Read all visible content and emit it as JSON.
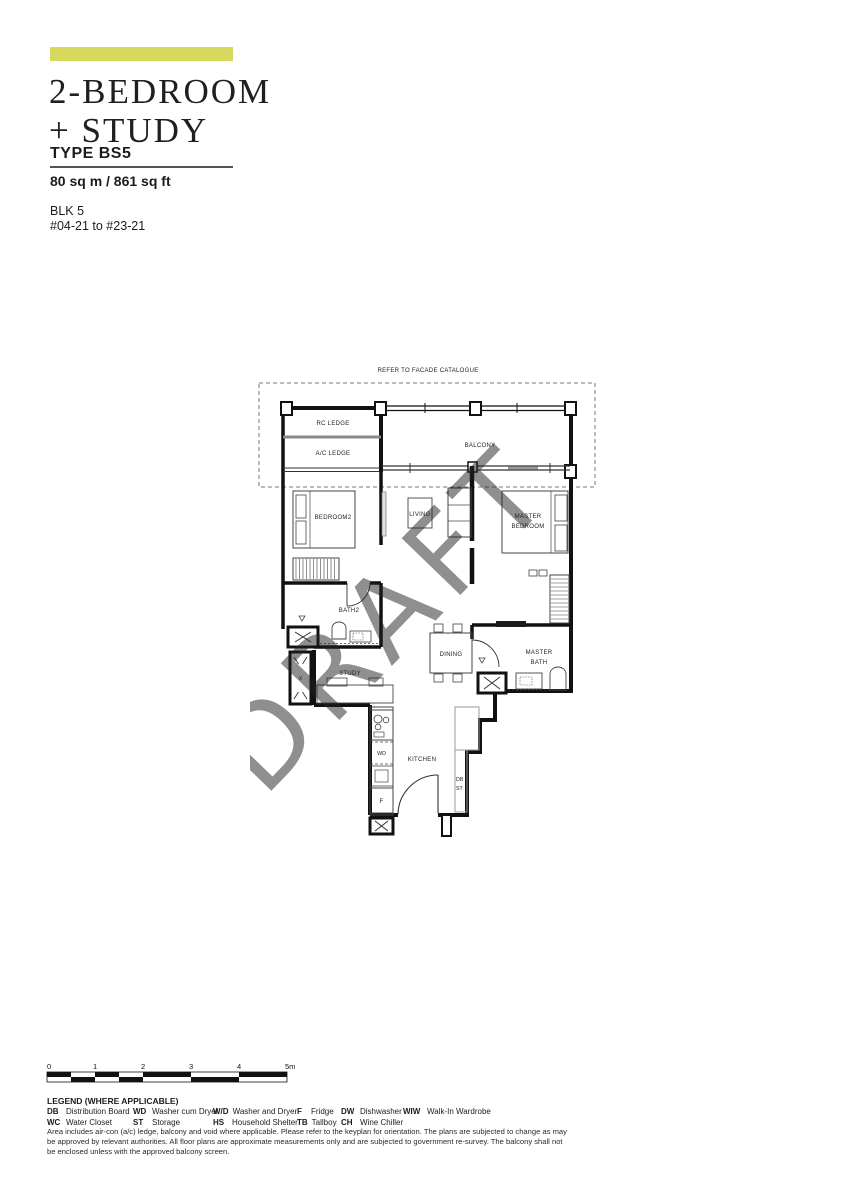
{
  "header": {
    "accent_color": "#d6d95c",
    "title_line1": "2-BEDROOM",
    "title_line2": "+ STUDY",
    "type_label": "TYPE BS5",
    "area": "80 sq m / 861 sq ft",
    "block": "BLK 5",
    "unit_range": "#04-21 to #23-21"
  },
  "floorplan": {
    "facade_note": "REFER TO FACADE CATALOGUE",
    "watermark": "DRAFT",
    "watermark_color": "#9fb6a9",
    "labels": {
      "rc_ledge": "RC LEDGE",
      "ac_ledge": "A/C LEDGE",
      "balcony": "BALCONY",
      "bedroom2": "BEDROOM2",
      "living": "LIVING",
      "master_line1": "MASTER",
      "master_line2": "BEDROOM",
      "bath2": "BATH2",
      "study": "STUDY",
      "dining": "DINING",
      "master_bath_line1": "MASTER",
      "master_bath_line2": "BATH",
      "kitchen": "KITCHEN",
      "washer_dryer": "WD",
      "fridge": "F",
      "db": "DB",
      "st": "ST",
      "ac_x": "X"
    }
  },
  "scalebar": {
    "labels": [
      "0",
      "1",
      "2",
      "3",
      "4",
      "5m"
    ]
  },
  "legend": {
    "title": "LEGEND (WHERE APPLICABLE)",
    "entries": [
      {
        "abbr": "DB",
        "desc": "Distribution Board"
      },
      {
        "abbr": "WC",
        "desc": "Water Closet"
      },
      {
        "abbr": "WD",
        "desc": "Washer cum Dryer"
      },
      {
        "abbr": "ST",
        "desc": "Storage"
      },
      {
        "abbr": "W/D",
        "desc": "Washer and Dryer"
      },
      {
        "abbr": "HS",
        "desc": "Household Shelter"
      },
      {
        "abbr": "F",
        "desc": "Fridge"
      },
      {
        "abbr": "TB",
        "desc": "Tallboy"
      },
      {
        "abbr": "DW",
        "desc": "Dishwasher"
      },
      {
        "abbr": "CH",
        "desc": "Wine Chiller"
      },
      {
        "abbr": "WIW",
        "desc": "Walk-In Wardrobe"
      }
    ]
  },
  "disclaimer": "Area includes air-con (a/c) ledge, balcony and void where applicable. Please refer to the keyplan for orientation. The plans are subjected to change as may be approved by relevant authorities. All floor plans are approximate measurements only and are subjected to government re-survey. The balcony shall not be enclosed unless with the approved balcony screen."
}
